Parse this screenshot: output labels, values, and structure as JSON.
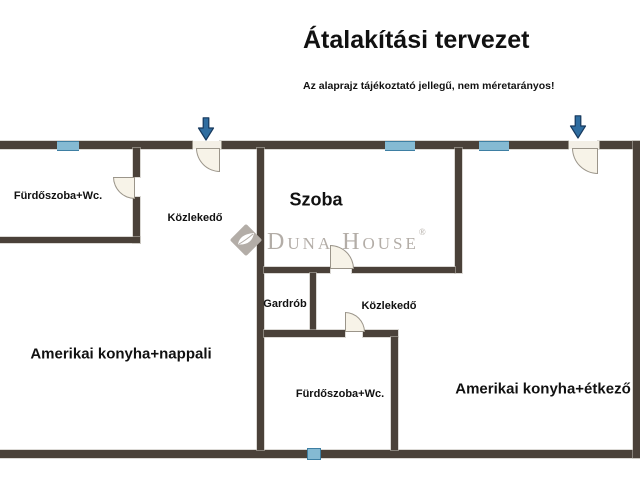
{
  "header": {
    "title": "Átalakítási tervezet",
    "disclaimer": "Az alaprajz tájékoztató jellegű, nem méretarányos!"
  },
  "watermark": {
    "brand": "Duna House",
    "registered": "®"
  },
  "rooms": {
    "bathroom_top": "Fürdőszoba+Wc.",
    "hall_top": "Közlekedő",
    "room": "Szoba",
    "wardrobe": "Gardrób",
    "hall_mid": "Közlekedő",
    "bathroom_bottom": "Fürdőszoba+Wc.",
    "living": "Amerikai konyha+nappali",
    "dining": "Amerikai konyha+étkező"
  },
  "colors": {
    "wall": "#4a4139",
    "window": "#85bad3",
    "window_border": "#3e7fa3",
    "door": "#f7f3e8",
    "door_border": "#9b958a",
    "arrow": "#2f6da0",
    "arrow_stroke": "#17395e",
    "watermark": "#b3ada7",
    "text": "#111111"
  }
}
